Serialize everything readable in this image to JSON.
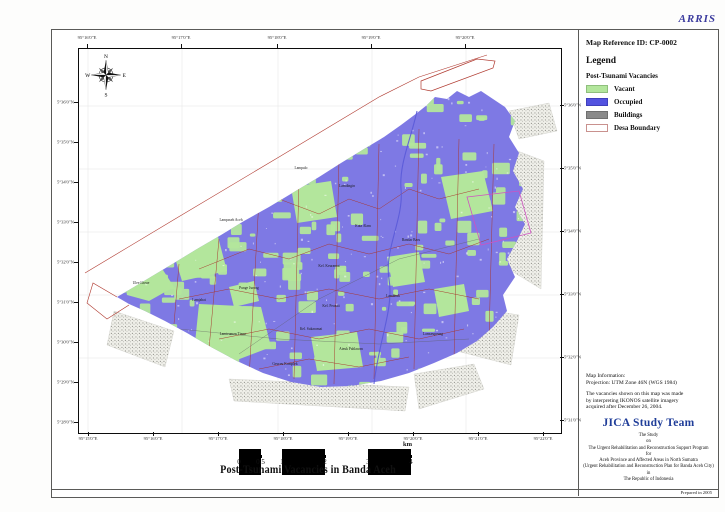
{
  "branding": {
    "watermark": "ARRIS",
    "prepared_note": "Prepared in 2005"
  },
  "panel": {
    "map_reference": "Map Reference ID: CP-0002",
    "legend": {
      "title": "Legend",
      "subtitle": "Post-Tsunami Vacancies",
      "items": [
        {
          "label": "Vacant",
          "color": "#b3e69c",
          "border": "#8fbf7d"
        },
        {
          "label": "Occupied",
          "color": "#5353e0",
          "border": "#4040bb"
        },
        {
          "label": "Buildings",
          "color": "#8a8a8a",
          "border": "#6f6f6f"
        },
        {
          "label": "Desa Boundary",
          "color": "#ffffff",
          "border": "#c9918e"
        }
      ]
    },
    "map_information": {
      "heading": "Map Information:",
      "projection": "Projection: UTM Zone 46N (WGS 1984)",
      "note_lines": [
        "The vacancies shown on this map  was made",
        "by interpreting IKONOS satellite imagery",
        "acquired after December 26, 2004."
      ]
    },
    "credits": {
      "team": "JICA Study Team",
      "lines": [
        "The Study",
        "on",
        "The Urgent Rehabilitation and Reconstruction Support Program",
        "for",
        "Aceh Province and Affected Areas in North Sumatra",
        "(Urgent Rehabilitation and Reconstruction Plan for Banda Aceh City)",
        "in",
        "The Republic of Indonesia"
      ]
    }
  },
  "map": {
    "title": "Post-Tsunami Vacancies in Banda Aceh",
    "compass_points": {
      "n": "N",
      "e": "E",
      "s": "S",
      "w": "W"
    },
    "scale_bar": {
      "tick_values": [
        0,
        0.5,
        1,
        2,
        3,
        4
      ],
      "tick_labels": [
        "0",
        "0.5",
        "1",
        "2",
        "3",
        "4"
      ],
      "unit": "km"
    },
    "graticule": {
      "top": [
        "95°16'0\"E",
        "95°17'0\"E",
        "95°18'0\"E",
        "95°19'0\"E",
        "95°20'0\"E"
      ],
      "bottom": [
        "95°15'0\"E",
        "95°16'0\"E",
        "95°17'0\"E",
        "95°18'0\"E",
        "95°19'0\"E",
        "95°20'0\"E",
        "95°21'0\"E",
        "95°22'0\"E"
      ],
      "left": [
        "5°36'0\"N",
        "5°35'0\"N",
        "5°34'0\"N",
        "5°33'0\"N",
        "5°32'0\"N",
        "5°31'0\"N",
        "5°30'0\"N",
        "5°29'0\"N",
        "5°28'0\"N"
      ],
      "right": [
        "5°36'0\"N",
        "5°35'0\"N",
        "5°34'0\"N",
        "5°33'0\"N",
        "5°32'0\"N",
        "5°31'0\"N"
      ]
    },
    "place_labels": [
      {
        "name": "Lampulo",
        "x": 222,
        "y": 120
      },
      {
        "name": "Lamdingin",
        "x": 268,
        "y": 138
      },
      {
        "name": "Kuta Alam",
        "x": 284,
        "y": 178
      },
      {
        "name": "Bandar Baru",
        "x": 332,
        "y": 192
      },
      {
        "name": "Kel. Keuramat",
        "x": 250,
        "y": 218
      },
      {
        "name": "Kel. Peuniti",
        "x": 252,
        "y": 258
      },
      {
        "name": "Lambhuk",
        "x": 314,
        "y": 248
      },
      {
        "name": "Kel. Sukaramai",
        "x": 232,
        "y": 281
      },
      {
        "name": "Ateuk Pahlawan",
        "x": 272,
        "y": 301
      },
      {
        "name": "Lamseupeung",
        "x": 354,
        "y": 286
      },
      {
        "name": "Punge Jurong",
        "x": 170,
        "y": 240
      },
      {
        "name": "Lampaseh Aceh",
        "x": 152,
        "y": 172
      },
      {
        "name": "Lamjabat",
        "x": 120,
        "y": 252
      },
      {
        "name": "Lamteumen Timur",
        "x": 154,
        "y": 286
      },
      {
        "name": "Geuceu Komplek",
        "x": 206,
        "y": 316
      },
      {
        "name": "Ulee Lheue",
        "x": 62,
        "y": 235
      }
    ]
  },
  "colors": {
    "occupied_map": "#7e79e4",
    "vacant": "#b3e69c",
    "desa_boundary": "#a8362c",
    "city_boundary": "#b03a30",
    "kecamatan": "#cf52c0",
    "river": "#5a5ad8",
    "credit_blue": "#1f3d99",
    "watermark_blue": "#3b3b9e"
  }
}
